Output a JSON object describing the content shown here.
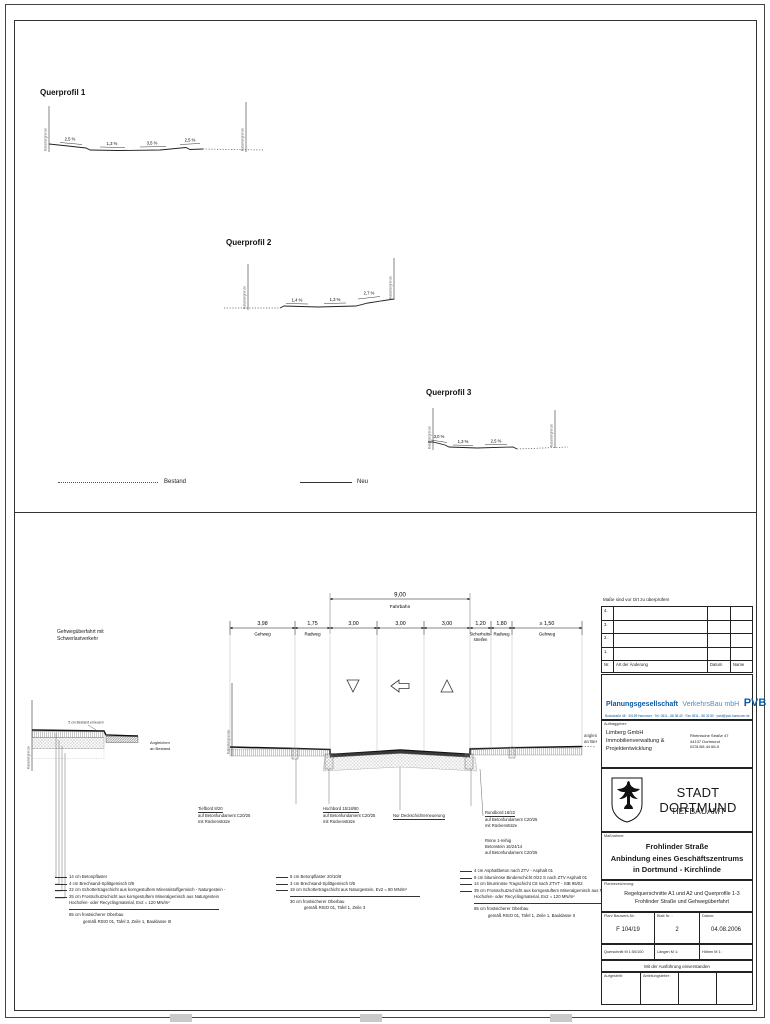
{
  "legend": {
    "bestand": "Bestand",
    "neu": "Neu"
  },
  "qp1": {
    "title": "Querprofil 1",
    "kg_left": "Katastergrenze",
    "kg_right": "Katastergrenze",
    "s1": "2,5 %",
    "s2": "1,3 %",
    "s3": "3,5 %",
    "s4": "2,5 %"
  },
  "qp2": {
    "title": "Querprofil 2",
    "kg_left": "Katastergrenze",
    "kg_right": "Katastergrenze",
    "s1": "1,4 %",
    "s2": "1,3 %",
    "s3": "2,7 %"
  },
  "qp3": {
    "title": "Querprofil 3",
    "kg_left": "Katastergrenze",
    "kg_right": "Katastergrenze",
    "s1": "3,0 %",
    "s2": "1,3 %",
    "s3": "2,5 %"
  },
  "detail_left": {
    "title1": "Gehwegüberfahrt mit",
    "title2": "Schwerlastverkehr",
    "kg": "Katastergrenze",
    "note_top": "5 cm Bestand erneuern",
    "note_right1": "Angleichen",
    "note_right2": "an Bestand",
    "l1": "14 cm Betonpflaster",
    "l2": "4 cm Brechsand-Splittgemisch 0/5",
    "l3": "22 cm Schottertragschicht aus korngestuftem Mineralstoffgemisch - Naturgestein -",
    "l4": "25 cm Frostschutzschicht aus korngestuftem Mineralgemisch aus Naturgestein",
    "l4b": "Hochofen- oder Recyclingmaterial, Ev2 = 120 MN/m²",
    "sum1": "65 cm frostsicherer Oberbau",
    "sum2": "gemäß RStO 01, Tafel 3, Zeile 1, Bauklasse III"
  },
  "main": {
    "total_value": "9,00",
    "total_label": "Fahrbahn",
    "d1v": "3,98",
    "d1l": "Gehweg",
    "d2v": "1,75",
    "d2l": "Radweg",
    "d3v": "3,00",
    "d4v": "3,00",
    "d5v": "3,00",
    "d6v": "1,20",
    "d6l1": "Sicherheits-",
    "d6l2": "streifen",
    "d7v": "1,80",
    "d7l": "Radweg",
    "d8v": "≥ 1,50",
    "d8l": "Gehweg",
    "kg": "Katastergrenze",
    "right_note1": "angleichen",
    "right_note2": "an Bestand",
    "tiefbord1": "Tiefbord 8/20",
    "tiefbord2": "auf Betonfundament C20/25",
    "tiefbord3": "mit Rückenstütze",
    "hochbord1": "Hochbord 15/18/80",
    "hochbord2": "auf Betonfundament C20/25",
    "hochbord3": "mit Rückenstütze",
    "deck": "Nur Deckschichterneuerung",
    "rundbord1": "Rundbord 18/22",
    "rundbord2": "auf Betonfundament C20/25",
    "rundbord3": "mit Rückenstütze",
    "rinne1": "Rinne 1-reihig",
    "rinne2": "Betonstein 16/24/14",
    "rinne3": "auf Betonfundament C20/25",
    "c1": "8 cm Betonpflaster 20/10/8",
    "c2": "3 cm Brechsand-Splittgemisch 0/5",
    "c3": "19 cm Schottertragschicht aus Naturgestein, Ev2 = 80 MN/m²",
    "csum1": "30 cm frostsicherer Oberbau",
    "csum2": "gemäß RStO 01, Tafel 1, Zeile 3",
    "r1": "4 cm Asphaltbeton nach ZTV - Asphalt 01",
    "r2": "8 cm bituminöse Binderschicht 0/22 S nach ZTV Asphalt 01",
    "r3": "14 cm bituminöse Tragschicht C8 nach ZTVT - StB 95/02",
    "r4": "39 cm Frostschutzschicht aus korngestuftem Mineralgemisch aus Naturgestein",
    "r4b": "Hochofen- oder Recyclingmaterial, Ev2 = 120 MN/m²",
    "rsum1": "65 cm frostsicherer Oberbau",
    "rsum2": "gemäß RStO 01, Tafel 1, Zeile 1, Bauklasse II"
  },
  "tb": {
    "note": "Maße sind vor Ort zu überprüfen!",
    "rev4": "4.",
    "rev3": "3.",
    "rev2": "2.",
    "rev1": "1.",
    "rev_nr": "Nr.",
    "rev_art": "Art der Änderung",
    "rev_datum": "Datum",
    "rev_name": "Name",
    "pvb_bold": "Planungsgesellschaft",
    "pvb_rest": "VerkehrsBau mbH",
    "pvb_logo": "PVB",
    "pvb_address": "Bockstraße 48 · 30159 Hannover · Tel. 0511 - 58 38 40 · Fax 0511 - 58 32 80 · post@pvb-hannover.de",
    "client_label": "Auftraggeber:",
    "client1": "Limberg GmbH",
    "client2": "Immobilienverwaltung &",
    "client3": "Projektentwicklung",
    "caddr1": "Rheinische Straße 47",
    "caddr2": "44137 Dortmund",
    "caddr3": "0231/58 44 66-0",
    "city": "STADT DORTMUND",
    "dept": "TIEFBAUAMT",
    "mass_label": "Maßnahme:",
    "mass1": "Frohlinder Straße",
    "mass2": "Anbindung eines Geschäftszentrums",
    "mass3": "in Dortmund - Kirchlinde",
    "plan_label": "Planbezeichnung:",
    "plan1": "Regelquerschnitte A1 und A2 und Querprofile 1-3",
    "plan2": "Frohlinder Straße und Gehwegüberfahrt",
    "plannr_label": "Plan/ Bauwerk-Nr:",
    "plannr": "F 104/19",
    "blatt_label": "Blatt Nr. :",
    "blatt": "2",
    "datum_label": "Datum:",
    "datum": "04.08.2006",
    "scale_q": "Querschnitt M 1:50/100",
    "scale_l": "Längen M 1:",
    "scale_h": "Höhen M 1:",
    "approve": "Mit der Ausführung einverstanden",
    "sig1": "Aufgestellt:",
    "sig2": "Abteilungsleiter:"
  }
}
